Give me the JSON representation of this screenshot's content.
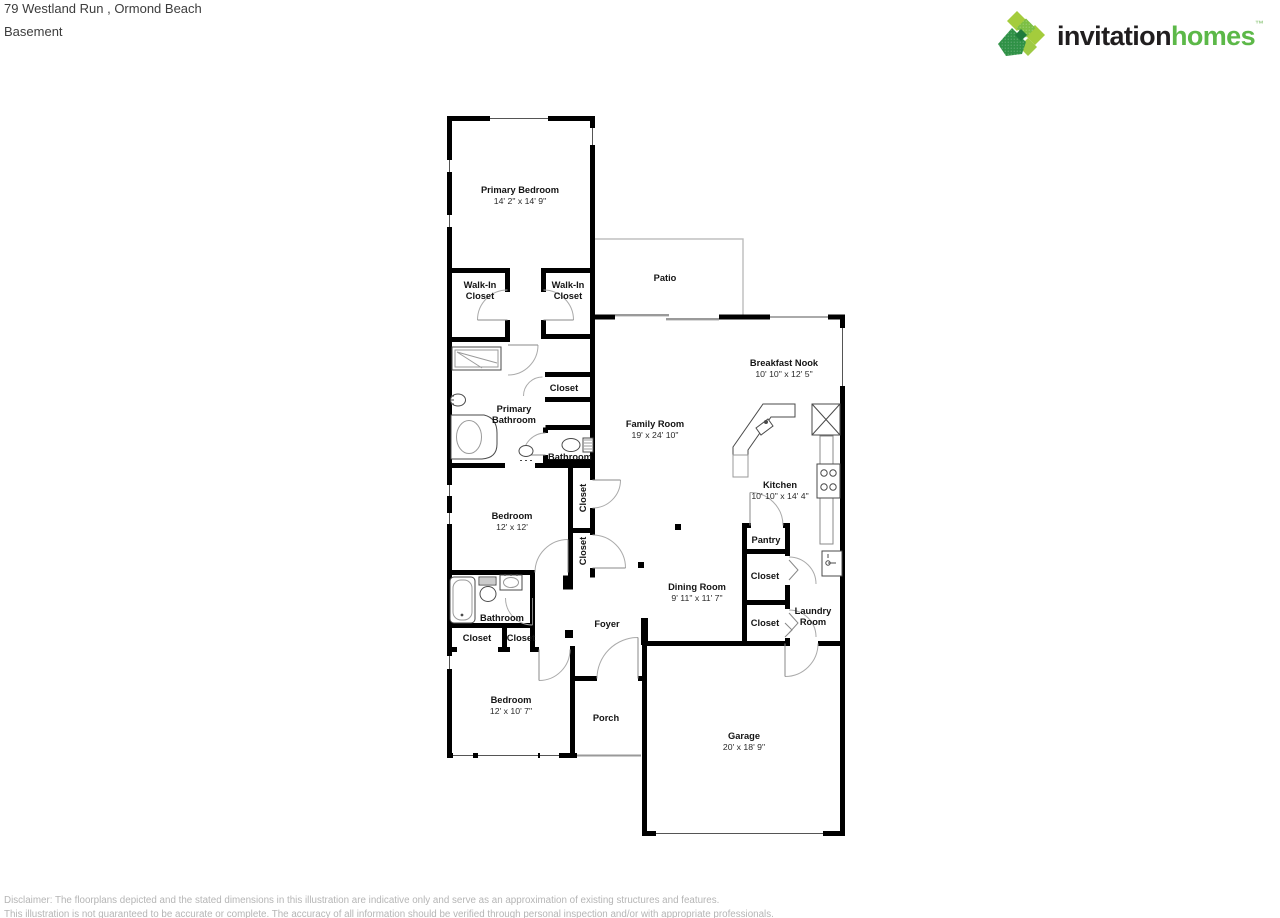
{
  "header": {
    "address_line": "79 Westland Run , Ormond Beach",
    "plan_label": "Basement"
  },
  "logo": {
    "brand_primary": "invitation",
    "brand_secondary": "homes",
    "trademark": "™",
    "text_color": "#211e1f",
    "green": "#5cb848",
    "mark_colors": [
      "#a4cc3c",
      "#7cbf44",
      "#2f9146",
      "#1f7c3d",
      "#9fca45"
    ]
  },
  "floor_plan": {
    "wall_color": "#000000",
    "door_arc_color": "#aaaaaa",
    "patio_outline_color": "#bbbbbb",
    "rooms": {
      "primary_bedroom": {
        "name": "Primary Bedroom",
        "dims": "14' 2\" x 14' 9\""
      },
      "walk_in_closet_left": {
        "line1": "Walk-In",
        "line2": "Closet"
      },
      "walk_in_closet_right": {
        "line1": "Walk-In",
        "line2": "Closet"
      },
      "patio": {
        "name": "Patio"
      },
      "breakfast_nook": {
        "name": "Breakfast Nook",
        "dims": "10' 10\" x 12' 5\""
      },
      "family_room": {
        "name": "Family Room",
        "dims": "19' x 24' 10\""
      },
      "primary_bathroom": {
        "line1": "Primary",
        "line2": "Bathroom"
      },
      "hall_closet": {
        "name": "Closet"
      },
      "hall_bathroom": {
        "name": "Bathroom"
      },
      "kitchen": {
        "name": "Kitchen",
        "dims": "10' 10\" x 14' 4\""
      },
      "closet_vertical_upper": {
        "name": "Closet"
      },
      "closet_vertical_lower": {
        "name": "Closet"
      },
      "bedroom_middle": {
        "name": "Bedroom",
        "dims": "12' x 12'"
      },
      "dining_room": {
        "name": "Dining Room",
        "dims": "9' 11\" x 11' 7\""
      },
      "pantry": {
        "name": "Pantry"
      },
      "closet_right_upper": {
        "name": "Closet"
      },
      "closet_right_lower": {
        "name": "Closet"
      },
      "laundry_room": {
        "line1": "Laundry",
        "line2": "Room"
      },
      "lower_bathroom": {
        "name": "Bathroom"
      },
      "closet_bottom_left": {
        "name": "Closet"
      },
      "closet_bottom_right": {
        "name": "Closet"
      },
      "foyer": {
        "name": "Foyer"
      },
      "bedroom_lower": {
        "name": "Bedroom",
        "dims": "12' x 10' 7\""
      },
      "porch": {
        "name": "Porch"
      },
      "garage": {
        "name": "Garage",
        "dims": "20' x 18' 9\""
      }
    }
  },
  "footer": {
    "line1": "Disclaimer: The floorplans depicted and the stated dimensions in this illustration are indicative only and serve as an approximation of existing structures and features.",
    "line2": "This illustration is not guaranteed to be accurate or complete. The accuracy of all information should be verified through personal inspection and/or with appropriate professionals."
  }
}
